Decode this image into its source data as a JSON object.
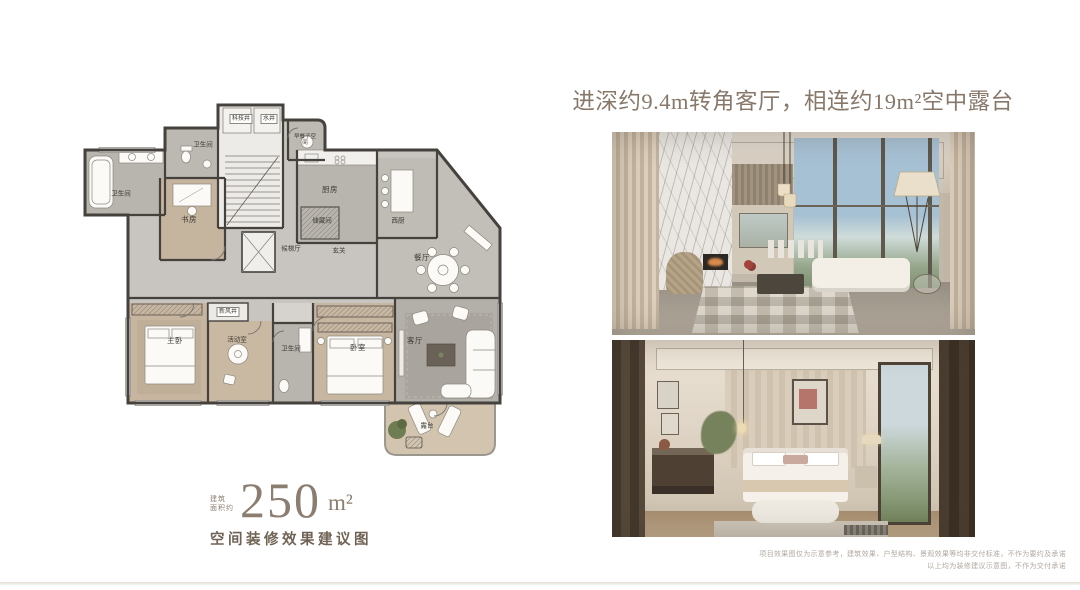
{
  "page": {
    "background": "#ffffff"
  },
  "floor_plan": {
    "area_prefix_line1": "建筑",
    "area_prefix_line2": "面积约",
    "area_value": "250",
    "area_unit": "m²",
    "caption": "空间装修效果建议图",
    "rooms": [
      {
        "label": "科技井",
        "x": 166,
        "y": 21,
        "kind": "shaft"
      },
      {
        "label": "水井",
        "x": 194,
        "y": 21,
        "kind": "shaft"
      },
      {
        "label": "卫生间",
        "x": 128,
        "y": 48,
        "kind": "room-s"
      },
      {
        "label": "早餐子空间",
        "x": 230,
        "y": 43,
        "kind": "wrap"
      },
      {
        "label": "卫生间",
        "x": 46,
        "y": 97,
        "kind": "room-s"
      },
      {
        "label": "书房",
        "x": 114,
        "y": 122,
        "kind": "room"
      },
      {
        "label": "厨房",
        "x": 255,
        "y": 92,
        "kind": "room"
      },
      {
        "label": "储藏间",
        "x": 247,
        "y": 124,
        "kind": "room-s"
      },
      {
        "label": "西厨",
        "x": 323,
        "y": 124,
        "kind": "room-s"
      },
      {
        "label": "候梯厅",
        "x": 216,
        "y": 152,
        "kind": "room-s"
      },
      {
        "label": "玄关",
        "x": 264,
        "y": 154,
        "kind": "room-s"
      },
      {
        "label": "餐厅",
        "x": 347,
        "y": 160,
        "kind": "room"
      },
      {
        "label": "新风井",
        "x": 153,
        "y": 214,
        "kind": "shaft"
      },
      {
        "label": "主卧",
        "x": 100,
        "y": 243,
        "kind": "room"
      },
      {
        "label": "活动室",
        "x": 162,
        "y": 243,
        "kind": "room-s"
      },
      {
        "label": "卫生间",
        "x": 216,
        "y": 252,
        "kind": "room-s"
      },
      {
        "label": "卧室",
        "x": 283,
        "y": 250,
        "kind": "room"
      },
      {
        "label": "客厅",
        "x": 340,
        "y": 243,
        "kind": "room"
      },
      {
        "label": "露台",
        "x": 352,
        "y": 329,
        "kind": "room-s"
      }
    ]
  },
  "right_panel": {
    "headline": "进深约9.4m转角客厅，相连约19m²空中露台",
    "disclaimer_lines": [
      "项目效果图仅为示意参考，建筑效果、户型结构、景观效果等均非交付标准，不作为要约及承诺",
      "以上均为装修建议示意图，不作为交付承诺"
    ]
  },
  "colors": {
    "headline": "#87786a",
    "area_text": "#8b7d6f",
    "caption": "#706355",
    "disclaimer": "#b2a89f",
    "plan_wall": "#45423e"
  }
}
